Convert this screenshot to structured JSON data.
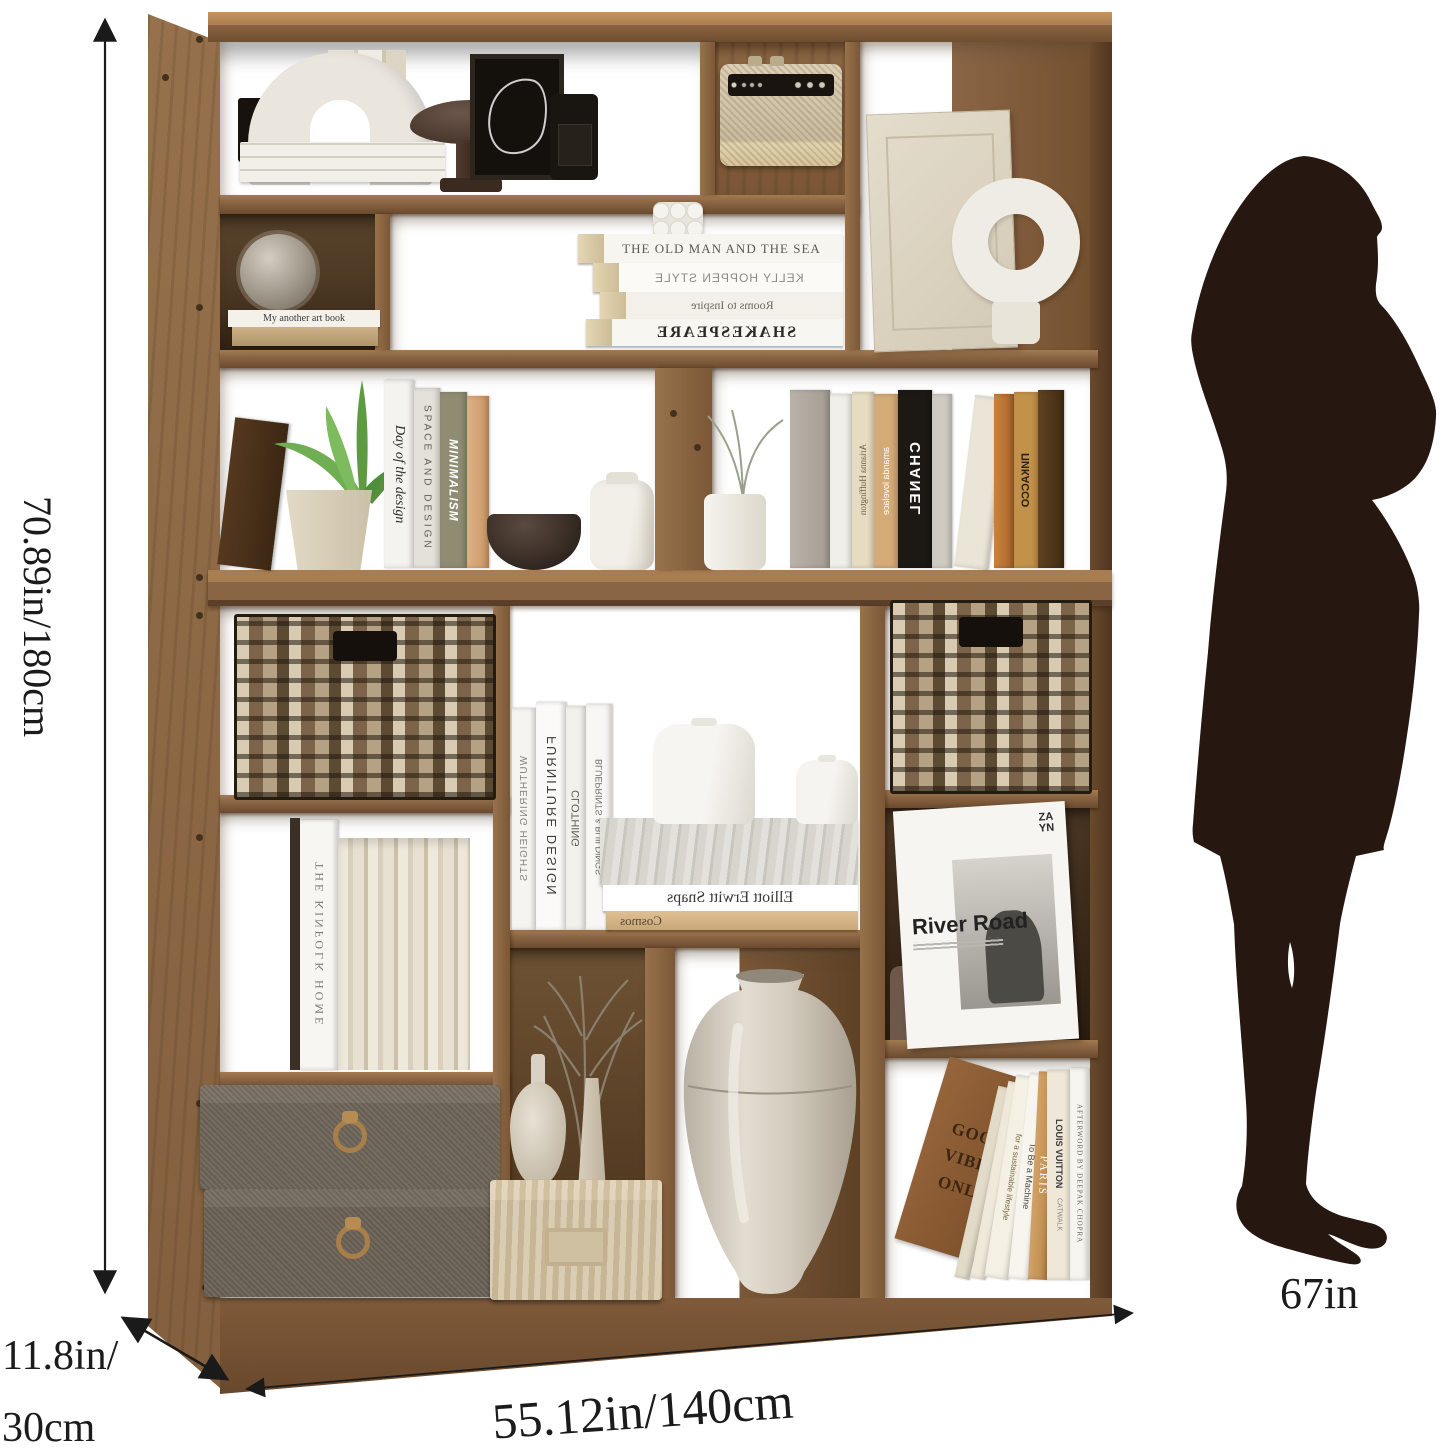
{
  "annotations": {
    "height": "70.89in/180cm",
    "depth_line1": "11.8in/",
    "depth_line2": "30cm",
    "width": "55.12in/140cm",
    "person_height": "67in"
  },
  "shelf": {
    "flat_book_label": "My another art book",
    "stacked_books_row2": [
      "THE OLD MAN AND THE SEA",
      "KELLY HOPPEN STYLE",
      "Rooms to Inspire",
      "SHAKESPEARE"
    ],
    "row3_left_spines": [
      "Day of the design",
      "SPACE AND DESIGN",
      "MINIMALISM"
    ],
    "row3_right_spines": [
      "Arianna Huffington",
      "amanda lovelace",
      "CHANEL",
      "ПИКАССО"
    ],
    "kinfolk_spine": "THE KINFOLK HOME",
    "mid_spines": [
      "WUTHERING HEIGHTS",
      "FURNITURE DESIGN",
      "CLOTHING",
      "BLUEPRINTS & BUILDINGS"
    ],
    "mid_stacked": [
      "Elliott Erwitt Snaps",
      "Cosmos"
    ],
    "river_book": {
      "brand_line1": "ZA",
      "brand_line2": "YN",
      "title": "River Road"
    },
    "bottom_right_spines": [
      "GOOD VIBES ONLY",
      "for a sustainable lifestyle",
      "To Be a Machine",
      "PARIS",
      "LOUIS VUITTON",
      "CATWALK",
      "AFTERWORD BY DEEPAK CHOPRA"
    ]
  },
  "colors": {
    "wood": "#8a6544",
    "wood_dark": "#5c3f28",
    "wood_light": "#b48758",
    "silhouette": "#261710",
    "dimension_line": "#1a1a1a"
  }
}
